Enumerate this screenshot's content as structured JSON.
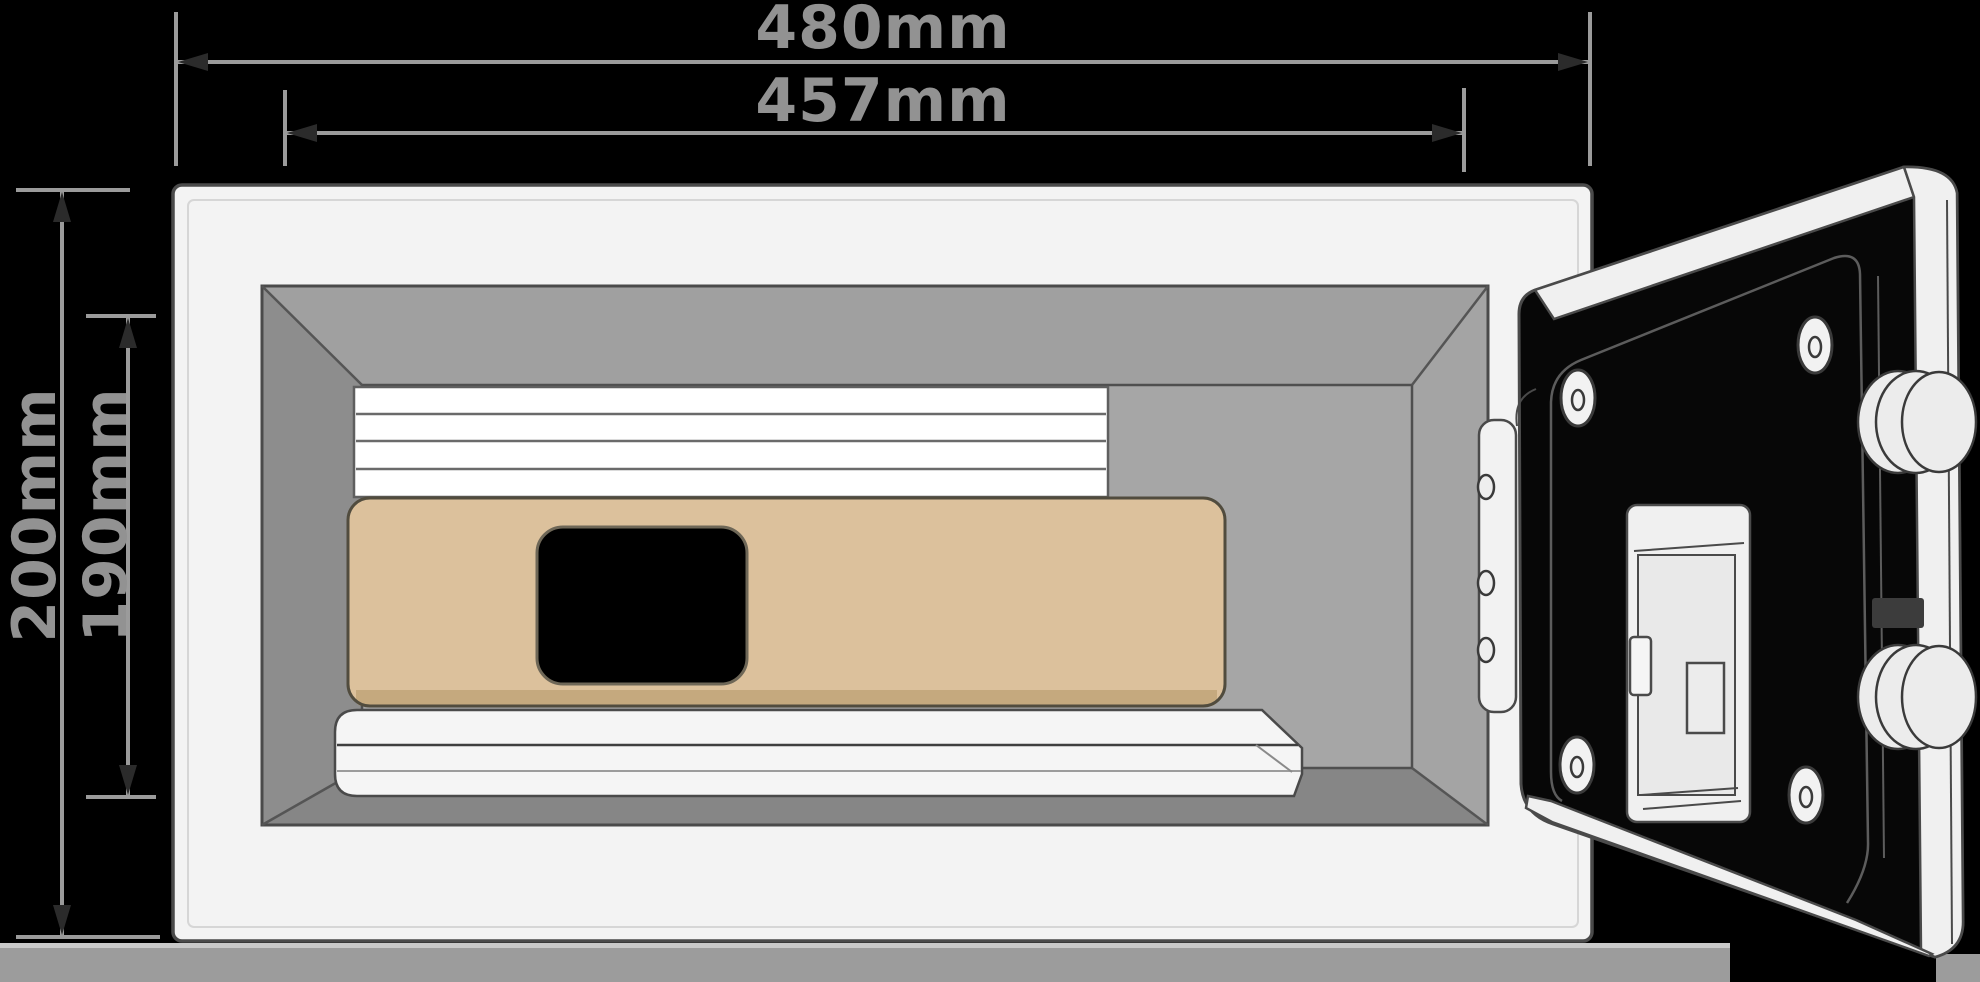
{
  "page": {
    "background": "#000000"
  },
  "dimension_labels": {
    "outer_width": "480mm",
    "inner_width": "457mm",
    "outer_height": "200mm",
    "inner_height": "190mm"
  },
  "colors": {
    "dim_line": "#9b9b9b",
    "dim_text": "#929292",
    "arrow": "#2b2b2b",
    "outline": "#4a4a4a",
    "safe_face": "#f3f3f3",
    "interior_top": "#a0a0a0",
    "interior_left": "#8d8d8d",
    "interior_right": "#a4a4a4",
    "interior_bottom": "#868686",
    "cavity": "#a6a6a6",
    "slats": "#ffffff",
    "laptop": "#dcc19c",
    "laptop_edge": "#c5a97e",
    "laptop_hole": "#000000",
    "shelf": "#f5f5f5",
    "floor": "#9c9c9c",
    "floor_highlight": "#c9c9c9",
    "door_face": "#070707",
    "door_band": "#f0f0f0",
    "metal": "#ececec",
    "latch_slot": "#3c3c3c"
  }
}
